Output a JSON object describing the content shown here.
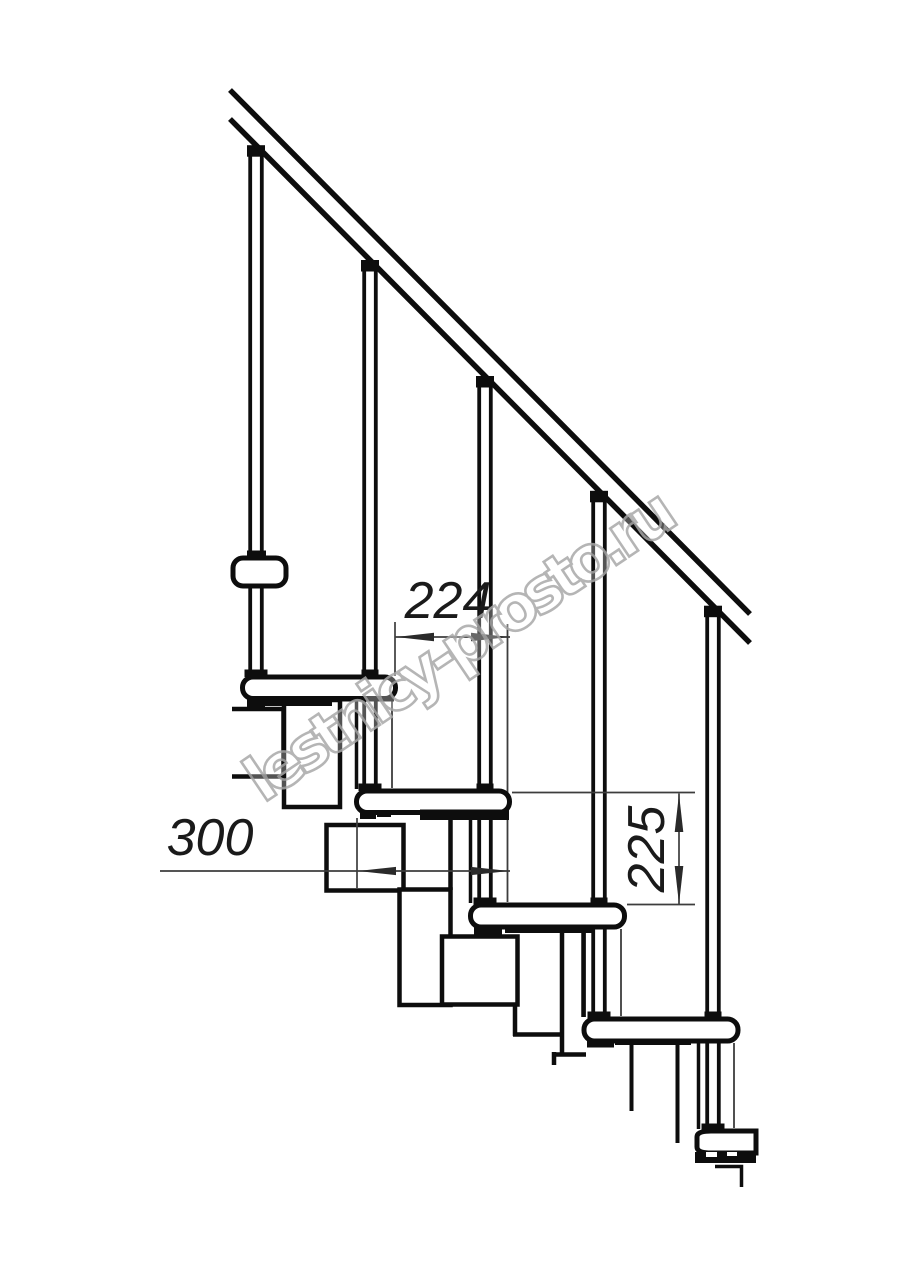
{
  "drawing": {
    "title": "modular staircase side elevation drawing",
    "watermark": "lestnicy-prosto.ru",
    "dimensions": {
      "step_run_mm": "224",
      "tread_depth_mm": "300",
      "riser_height_mm": "225"
    },
    "colors": {
      "line": "#0d0d0d",
      "dimension_line": "#3d3d3d",
      "watermark_stroke": "#a9a9a9",
      "background": "#ffffff"
    }
  }
}
